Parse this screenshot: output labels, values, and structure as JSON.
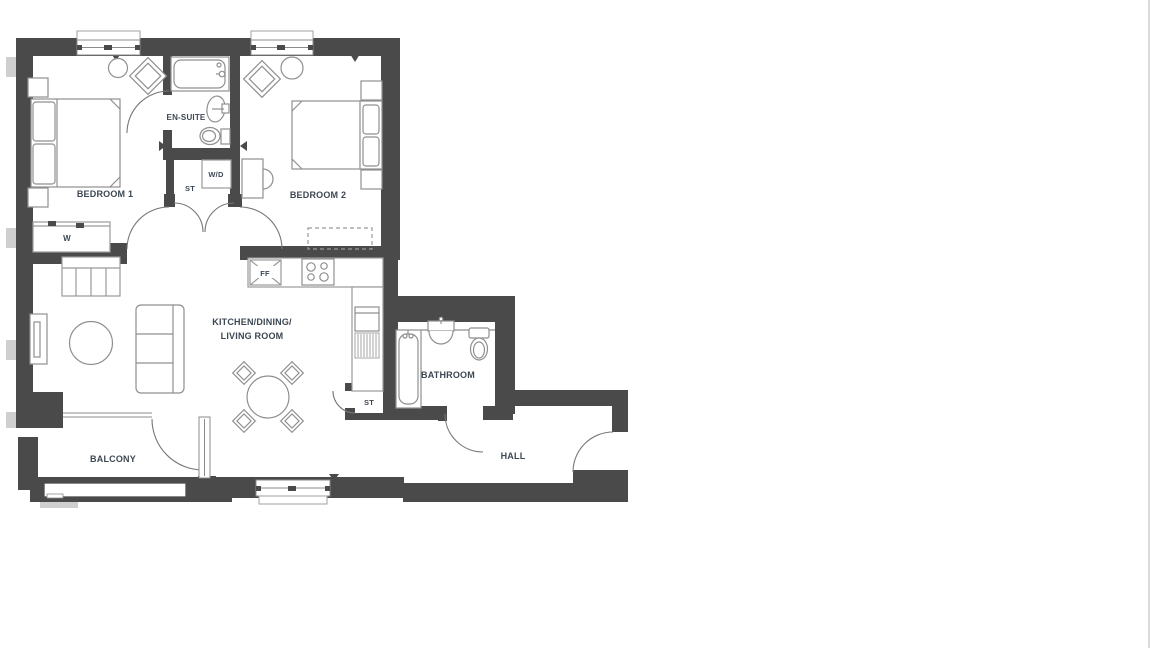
{
  "plan": {
    "type": "apartment-floorplan",
    "colors": {
      "wall": "#4a4a4b",
      "furniture": "#8f8f8f",
      "detail": "#9a9a9a",
      "label": "#3d4753",
      "outside_stub": "#cfcfcf",
      "edge_line": "#d9d9d9"
    },
    "rooms": {
      "bedroom1": {
        "label": "BEDROOM 1"
      },
      "bedroom2": {
        "label": "BEDROOM 2"
      },
      "ensuite": {
        "label": "EN-SUITE"
      },
      "washer_dryer": {
        "label": "W/D"
      },
      "storage_upper": {
        "label": "ST"
      },
      "wardrobe": {
        "label": "W"
      },
      "living": {
        "label_line1": "KITCHEN/DINING/",
        "label_line2": "LIVING ROOM"
      },
      "fridge_freezer": {
        "label": "FF"
      },
      "storage_lower": {
        "label": "ST"
      },
      "bathroom": {
        "label": "BATHROOM"
      },
      "hall": {
        "label": "HALL"
      },
      "balcony": {
        "label": "BALCONY"
      }
    }
  }
}
